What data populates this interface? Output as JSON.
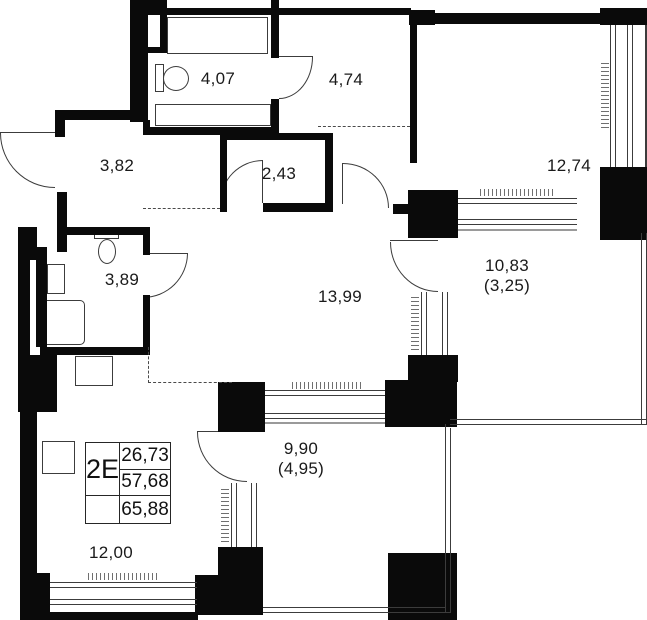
{
  "plan": {
    "colors": {
      "walls": "#0a0a0a",
      "thin_lines": "#3c3c3c",
      "background": "#ffffff"
    },
    "rooms": [
      {
        "id": "bathroom",
        "area": "4,07"
      },
      {
        "id": "hallway",
        "area": "4,74"
      },
      {
        "id": "bedroom",
        "area": "12,74"
      },
      {
        "id": "entry-hall",
        "area": "3,82"
      },
      {
        "id": "corridor",
        "area": "2,43"
      },
      {
        "id": "wc",
        "area": "3,89"
      },
      {
        "id": "kitchen-living",
        "area": "13,99"
      },
      {
        "id": "loggia-large",
        "area": "10,83",
        "secondary": "(3,25)"
      },
      {
        "id": "loggia-small",
        "area": "9,90",
        "secondary": "(4,95)"
      },
      {
        "id": "living-room",
        "area": "12,00"
      }
    ],
    "info_box": {
      "unit_type": "2Е",
      "living_area": "26,73",
      "floor_area": "57,68",
      "total_area": "65,88"
    }
  }
}
